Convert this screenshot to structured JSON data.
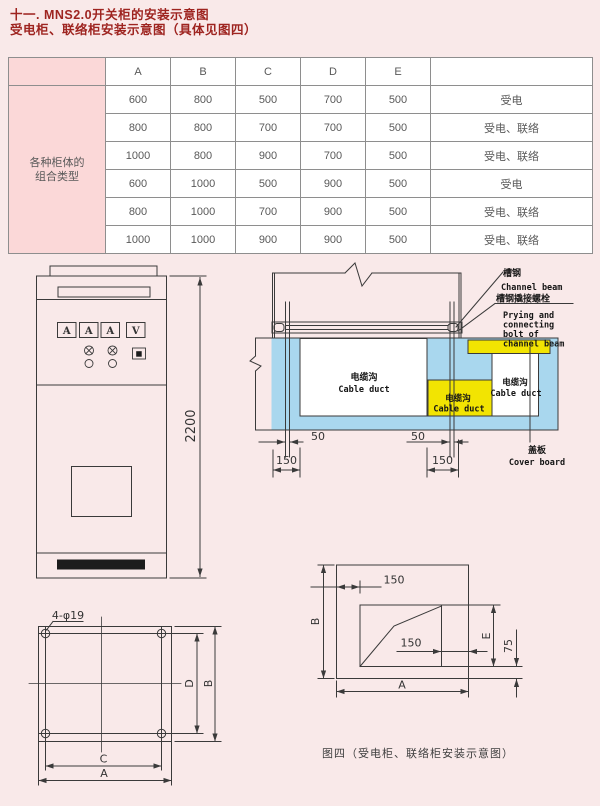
{
  "header": {
    "line1": "十一. MNS2.0开关柜的安装示意图",
    "line2": "受电柜、联络柜安装示意图（具体见图四）"
  },
  "table": {
    "columns": [
      "A",
      "B",
      "C",
      "D",
      "E"
    ],
    "type_column_header": "",
    "row_group_label": "各种柜体的\n组合类型",
    "rows": [
      [
        "600",
        "800",
        "500",
        "700",
        "500",
        "受电"
      ],
      [
        "800",
        "800",
        "700",
        "700",
        "500",
        "受电、联络"
      ],
      [
        "1000",
        "800",
        "900",
        "700",
        "500",
        "受电、联络"
      ],
      [
        "600",
        "1000",
        "500",
        "900",
        "500",
        "受电"
      ],
      [
        "800",
        "1000",
        "700",
        "900",
        "500",
        "受电、联络"
      ],
      [
        "1000",
        "1000",
        "900",
        "900",
        "500",
        "受电、联络"
      ]
    ]
  },
  "front_view": {
    "meters": [
      "A",
      "A",
      "A",
      "V"
    ],
    "height_dim": "2200"
  },
  "section_view": {
    "channel_beam_cn": "槽钢",
    "channel_beam_en": "Channel beam",
    "bolt_cn": "槽钢撬接螺栓",
    "bolt_en_lines": [
      "Prying and",
      "connecting",
      "bolt of",
      "channel beam"
    ],
    "cover_cn": "盖板",
    "cover_en": "Cover board",
    "duct_cn": "电缆沟",
    "duct_en": "Cable duct",
    "dim_50": "50",
    "dim_150": "150"
  },
  "base_plan": {
    "holes_label": "4-φ19",
    "dim_a": "A",
    "dim_b": "B",
    "dim_c": "C",
    "dim_d": "D"
  },
  "figure4": {
    "dim_150_top": "150",
    "dim_150_inner": "150",
    "dim_a": "A",
    "dim_b": "B",
    "dim_e": "E",
    "dim_75": "75",
    "caption": "图四（受电柜、联络柜安装示意图）"
  },
  "colors": {
    "background": "#f9e9e9",
    "accent_red": "#9e2420",
    "table_header_pink": "#fbd8d8",
    "duct_blue": "#a9d7ee",
    "duct_yellow": "#f2e402",
    "line": "#3a3a3a"
  }
}
